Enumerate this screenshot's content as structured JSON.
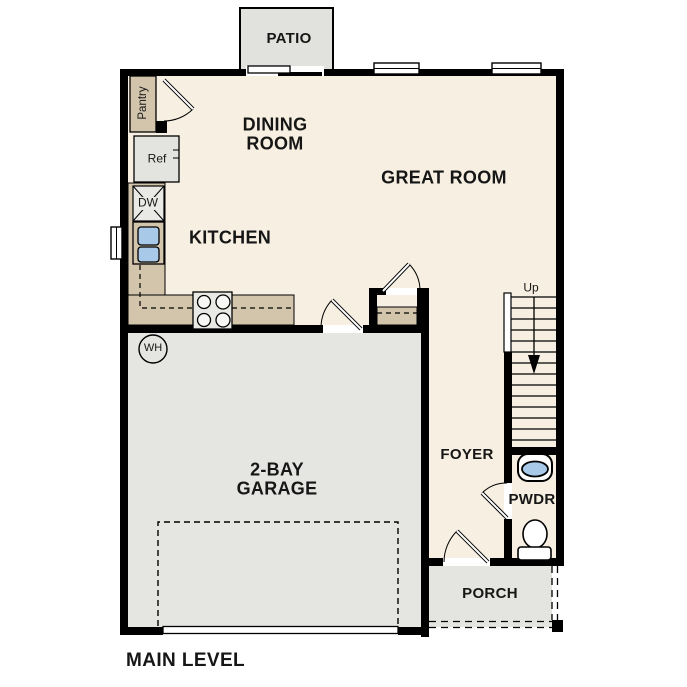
{
  "plan": {
    "title": "MAIN LEVEL",
    "rooms": {
      "patio": "PATIO",
      "dining_room": "DINING ROOM",
      "great_room": "GREAT ROOM",
      "kitchen": "KITCHEN",
      "garage": "2-BAY GARAGE",
      "foyer": "FOYER",
      "powder_room": "PWDR",
      "porch": "PORCH"
    },
    "fixtures": {
      "pantry": "Pantry",
      "refrigerator": "Ref",
      "dishwasher": "DW",
      "water_heater": "WH",
      "stairs_direction": "Up"
    },
    "icons": {
      "stairs_direction_arrow": "arrow-down"
    },
    "colors": {
      "wall": "#000000",
      "floor": "#F7F0E2",
      "counter_tan": "#D2C5AC",
      "garage_gray": "#E5E5E2",
      "porch_gray": "#E4E4E1",
      "patio_gray": "#E1E1DE",
      "appliance_gray": "#E9E9E6",
      "sink_blue": "#A9C9E9",
      "background": "#FFFFFF"
    }
  }
}
